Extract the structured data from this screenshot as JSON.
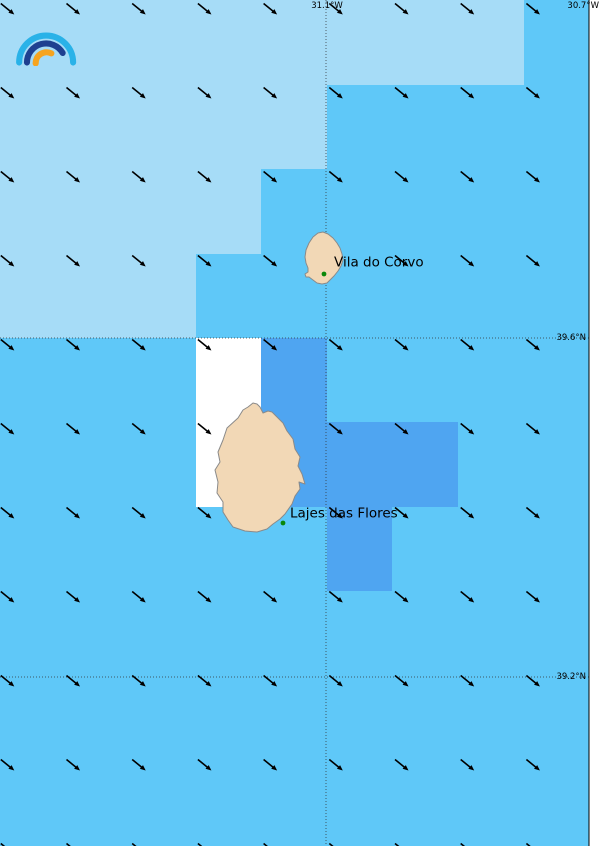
{
  "map": {
    "width": 600,
    "height": 846,
    "inner_right": 589,
    "colors": {
      "sea_light": "#a6dcf7",
      "sea_medium": "#5fc8f8",
      "sea_dark": "#4fa5f1",
      "sea_calm_white": "#ffffff",
      "land": "#f2d8b6",
      "land_outline": "#8a8a8a",
      "place_dot": "#0a870a",
      "arrow": "#000000",
      "gridline": "#333333",
      "border": "#000000",
      "margin": "#ffffff"
    },
    "grid_labels": [
      {
        "text": "31.1°W",
        "x": 327,
        "y": 6,
        "anchor": "middle"
      },
      {
        "text": "30.7°W",
        "x": 599,
        "y": 6,
        "anchor": "end"
      },
      {
        "text": "39.6°N",
        "x": 586,
        "y": 338,
        "anchor": "end"
      },
      {
        "text": "39.2°N",
        "x": 586,
        "y": 677,
        "anchor": "end"
      }
    ],
    "gridlines": {
      "vertical_x": [
        326
      ],
      "horizontal_y": [
        338,
        677
      ]
    },
    "regions": {
      "light_poly": "0,0 524,0 524,85 327,85 327,169 261,169 261,254 196,254 196,338 0,338",
      "white_rect": [
        196,
        338,
        65,
        169
      ],
      "dark_rects": [
        [
          261,
          338,
          66,
          169
        ],
        [
          327,
          422,
          131,
          85
        ],
        [
          327,
          507,
          65,
          84
        ]
      ]
    },
    "islands": [
      {
        "name": "Corvo",
        "points": "318,233 323,232 328,234 333,238 337,243 340,248 342,254 343,260 341,266 338,271 334,276 330,280 327,283 322,284 317,283 313,280 309,277 306,277 305,274 308,272 308,268 306,263 305,257 306,250 309,243 313,237"
      },
      {
        "name": "Flores",
        "points": "253,403 257,404 260,407 263,413 268,411 272,412 277,417 283,423 287,431 293,439 295,449 300,457 298,466 302,474 305,484 299,482 300,489 295,496 292,504 285,514 280,519 273,524 267,529 257,532 245,531 233,527 228,520 223,512 223,502 217,493 218,482 215,470 220,462 218,452 223,440 227,428 238,418 243,410 248,407"
      }
    ],
    "places": [
      {
        "name": "Vila do Corvo",
        "label_x": 334,
        "label_y": 263,
        "dot_x": 324,
        "dot_y": 274
      },
      {
        "name": "Lajes das Flores",
        "label_x": 290,
        "label_y": 514,
        "dot_x": 283,
        "dot_y": 523
      }
    ],
    "wind_grid": {
      "x0": 0.8,
      "dx": 65.7,
      "cols": 9,
      "y0": 3.5,
      "dy": 84.0,
      "rows": 11,
      "direction": "northwest-to-southeast",
      "skip": [
        [
          5,
          3
        ],
        [
          4,
          5
        ],
        [
          4,
          6
        ]
      ]
    }
  },
  "logo": {
    "arc_outer": "#29b2e8",
    "arc_middle": "#1e4090",
    "arc_inner": "#f6a41f"
  }
}
